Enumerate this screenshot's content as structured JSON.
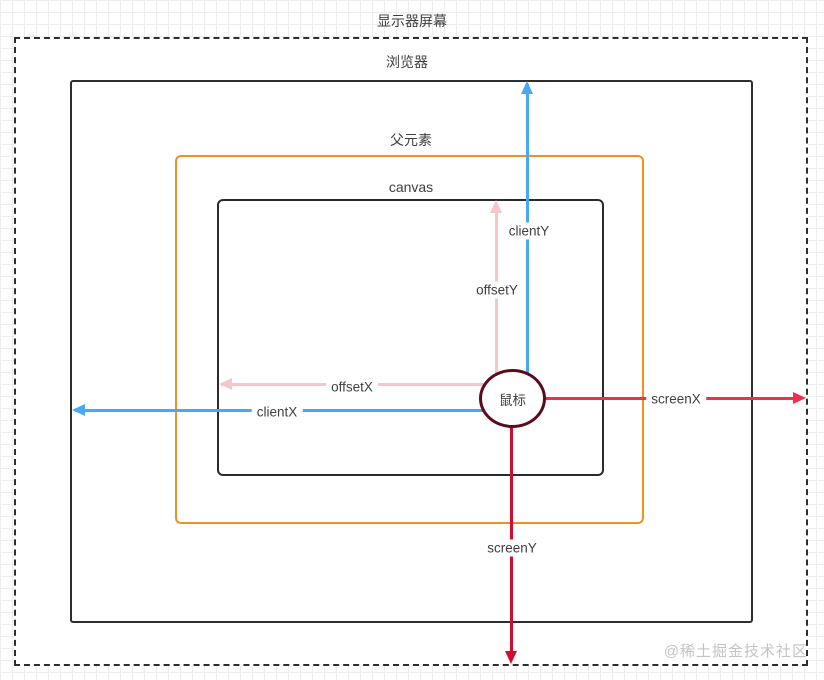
{
  "diagram": {
    "boxes": {
      "monitor": {
        "label": "显示器屏幕"
      },
      "browser": {
        "label": "浏览器"
      },
      "parent": {
        "label": "父元素"
      },
      "canvas": {
        "label": "canvas"
      }
    },
    "mouse": {
      "label": "鼠标"
    },
    "arrows": {
      "clientY": {
        "label": "clientY",
        "color": "#49a7f3",
        "direction": "up",
        "from": "mouse",
        "to": "browser-top"
      },
      "offsetY": {
        "label": "offsetY",
        "color": "#f6c6cb",
        "direction": "up",
        "from": "mouse",
        "to": "canvas-top"
      },
      "offsetX": {
        "label": "offsetX",
        "color": "#f6c6cb",
        "direction": "left",
        "from": "mouse",
        "to": "canvas-left"
      },
      "clientX": {
        "label": "clientX",
        "color": "#49a7f3",
        "direction": "left",
        "from": "mouse",
        "to": "browser-left"
      },
      "screenX": {
        "label": "screenX",
        "color": "#f03048",
        "direction": "right",
        "from": "mouse",
        "to": "monitor-right"
      },
      "screenY": {
        "label": "screenY",
        "color": "#cf0e2f",
        "direction": "down",
        "from": "mouse",
        "to": "monitor-bottom"
      }
    },
    "colors": {
      "monitor_border": "#2e2e2e",
      "browser_border": "#2e2e2e",
      "parent_border": "#f0911f",
      "canvas_border": "#2b2b2b",
      "mouse_border": "#5a0c1e",
      "label_text": "#3f3f3f",
      "grid_line": "#ededed",
      "watermark": "#c4c4c4"
    },
    "watermark": "@稀土掘金技术社区"
  }
}
